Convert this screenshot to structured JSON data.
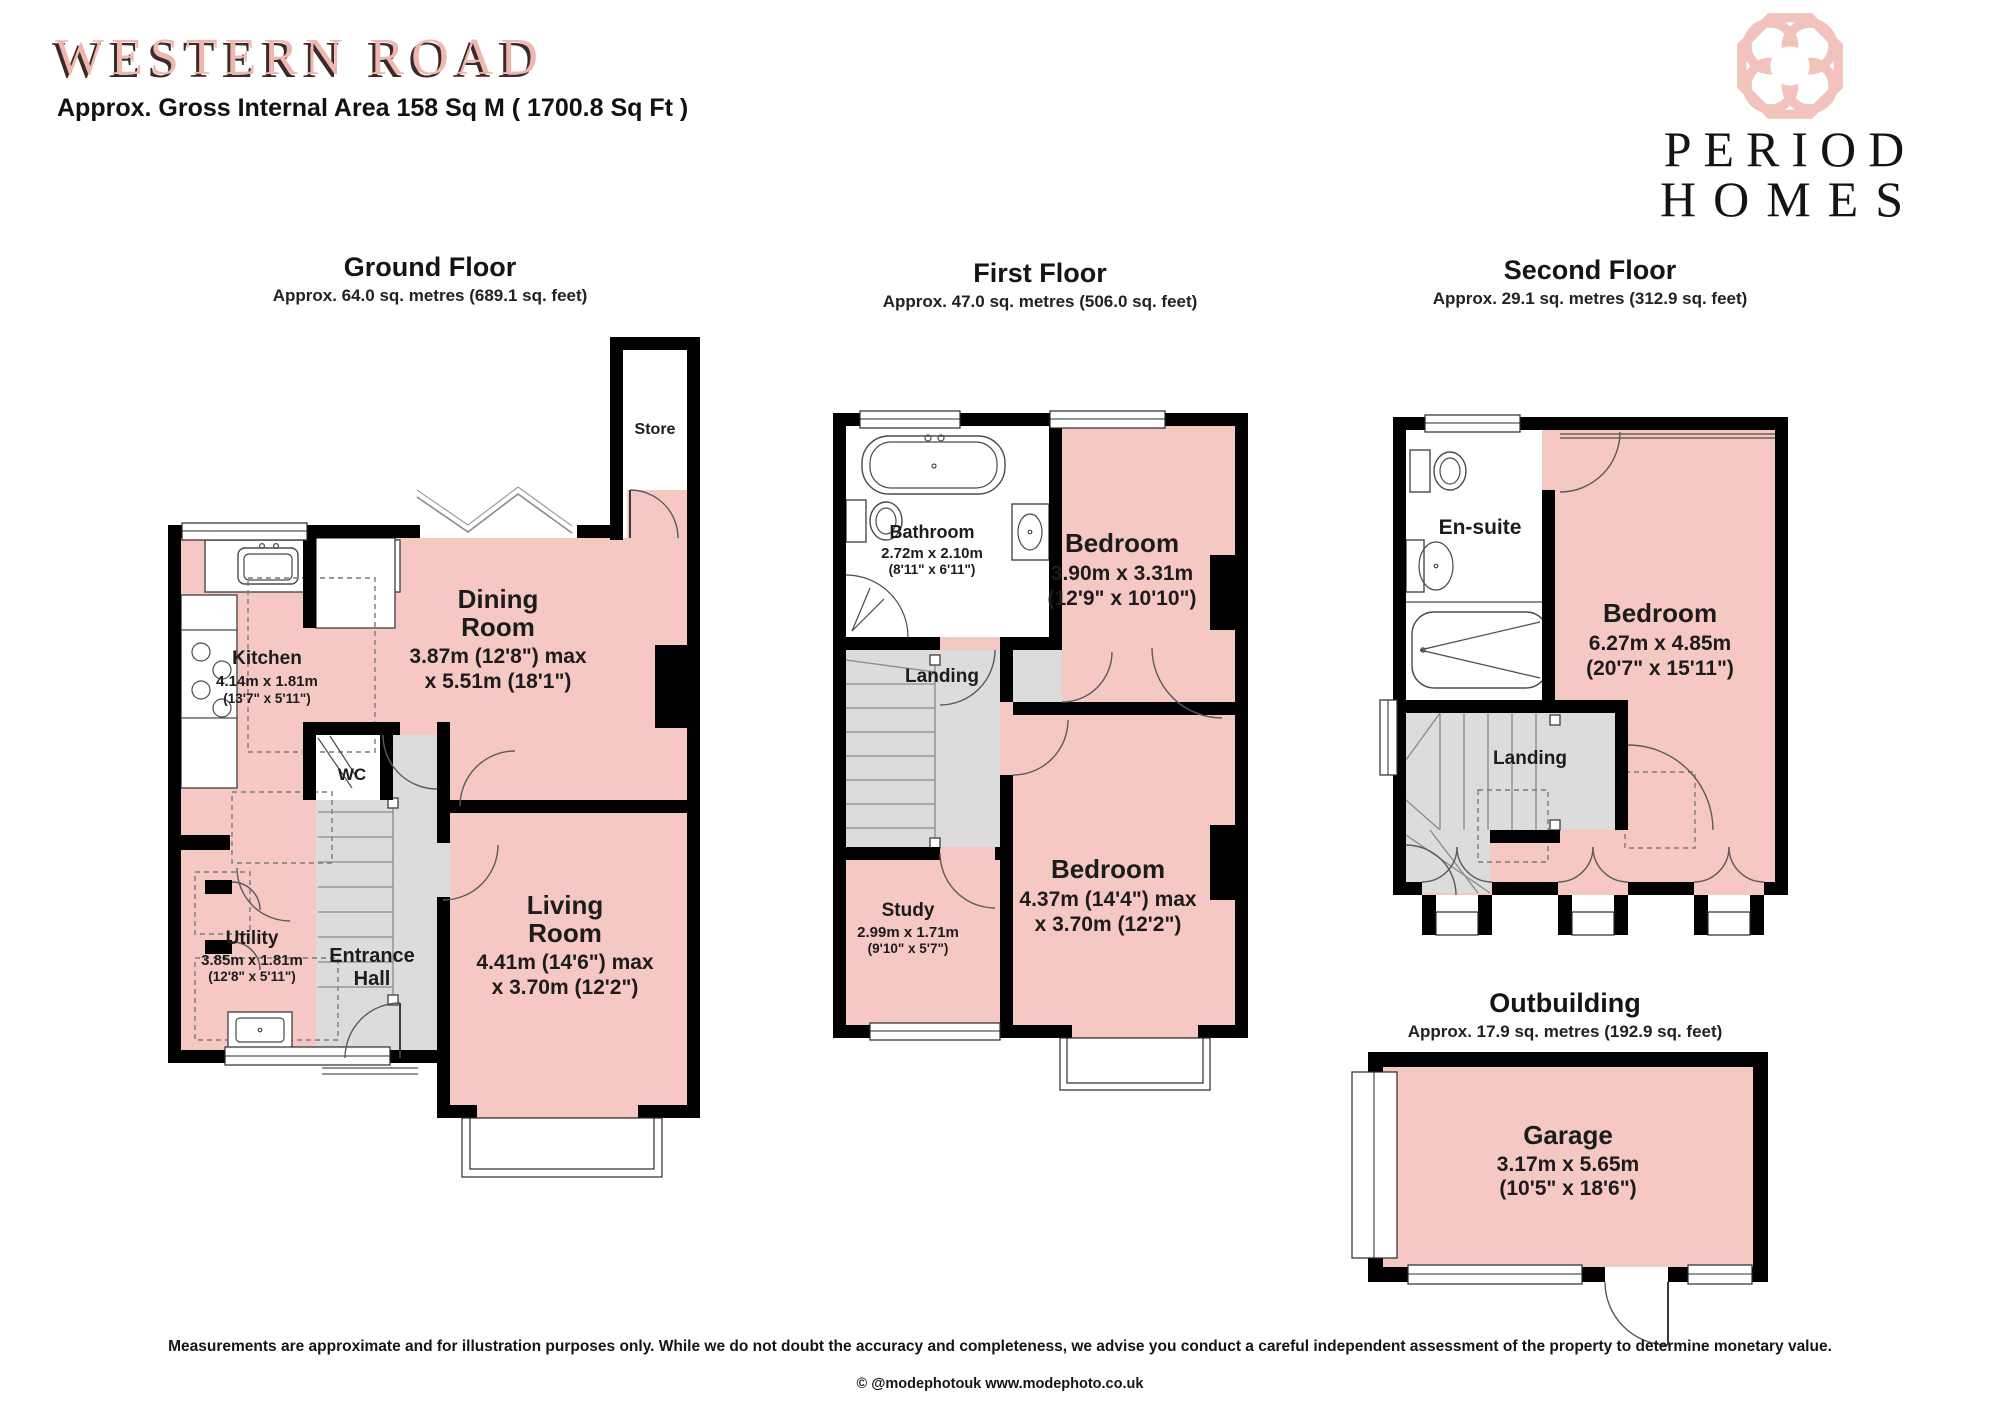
{
  "header": {
    "title": "WESTERN ROAD",
    "subtitle": "Approx. Gross Internal Area 158 Sq M ( 1700.8 Sq Ft )",
    "brand_line1": "PERIOD",
    "brand_line2": "HOMES",
    "brand_logo_icon": "interlocking-rings-icon"
  },
  "palette": {
    "room_fill_pink": "#f6c8c3",
    "title_pink": "#f0b7b1",
    "hall_gray": "#dcdcdc",
    "wall_black": "#000000",
    "text_black": "#1c1c1c"
  },
  "floors": {
    "ground": {
      "title": "Ground Floor",
      "subtitle": "Approx. 64.0 sq. metres (689.1 sq. feet)",
      "rooms": {
        "store": {
          "name": "Store"
        },
        "kitchen": {
          "name": "Kitchen",
          "dim_m": "4.14m x 1.81m",
          "dim_ft": "(13'7\" x 5'11\")"
        },
        "dining": {
          "name1": "Dining",
          "name2": "Room",
          "dim1": "3.87m (12'8\") max",
          "dim2": "x 5.51m (18'1\")"
        },
        "wc": {
          "name": "WC"
        },
        "utility": {
          "name": "Utility",
          "dim_m": "3.85m x 1.81m",
          "dim_ft": "(12'8\" x 5'11\")"
        },
        "entrance": {
          "name1": "Entrance",
          "name2": "Hall"
        },
        "living": {
          "name1": "Living",
          "name2": "Room",
          "dim1": "4.41m (14'6\") max",
          "dim2": "x 3.70m (12'2\")"
        }
      }
    },
    "first": {
      "title": "First Floor",
      "subtitle": "Approx. 47.0 sq. metres (506.0 sq. feet)",
      "rooms": {
        "bathroom": {
          "name": "Bathroom",
          "dim_m": "2.72m x 2.10m",
          "dim_ft": "(8'11\" x 6'11\")"
        },
        "bedroom1": {
          "name": "Bedroom",
          "dim1": "3.90m x 3.31m",
          "dim2": "(12'9\" x 10'10\")"
        },
        "landing": {
          "name": "Landing"
        },
        "study": {
          "name": "Study",
          "dim_m": "2.99m x 1.71m",
          "dim_ft": "(9'10\" x 5'7\")"
        },
        "bedroom2": {
          "name": "Bedroom",
          "dim1": "4.37m (14'4\") max",
          "dim2": "x 3.70m (12'2\")"
        }
      }
    },
    "second": {
      "title": "Second Floor",
      "subtitle": "Approx. 29.1 sq. metres (312.9 sq. feet)",
      "rooms": {
        "ensuite": {
          "name": "En-suite"
        },
        "bedroom": {
          "name": "Bedroom",
          "dim1": "6.27m x 4.85m",
          "dim2": "(20'7\" x 15'11\")"
        },
        "landing": {
          "name": "Landing"
        }
      }
    },
    "outbuilding": {
      "title": "Outbuilding",
      "subtitle": "Approx. 17.9 sq. metres (192.9 sq. feet)",
      "rooms": {
        "garage": {
          "name": "Garage",
          "dim_m": "3.17m x 5.65m",
          "dim_ft": "(10'5\" x 18'6\")"
        }
      }
    }
  },
  "footer": {
    "disclaimer": "Measurements are approximate and for illustration purposes only.  While we do not doubt the accuracy and completeness, we advise you conduct a careful independent assessment of the property to determine monetary value.",
    "copyright": "© @modephotouk www.modephoto.co.uk"
  }
}
